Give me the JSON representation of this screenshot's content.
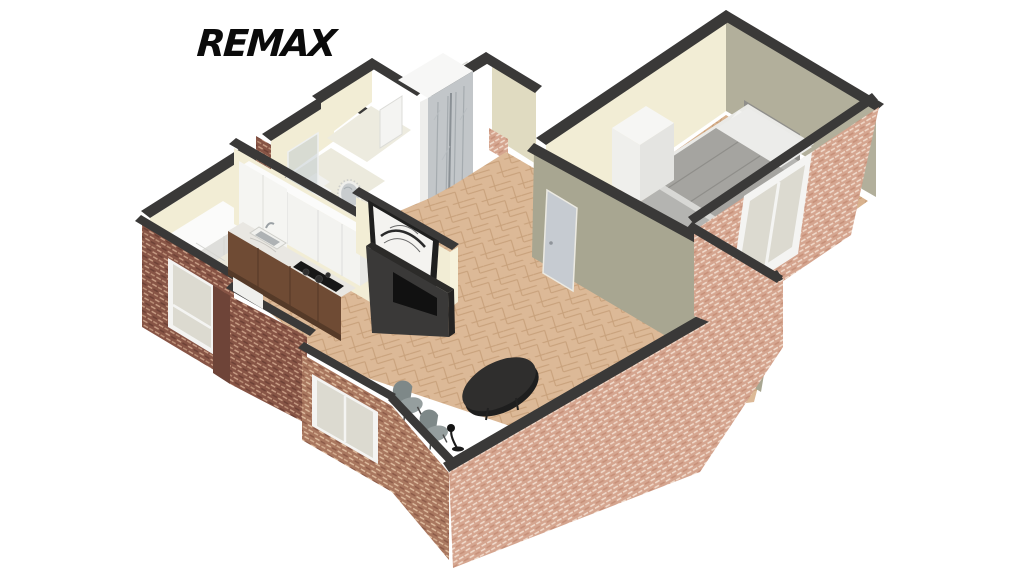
{
  "logo": {
    "text": "REMAX",
    "color": "#0b0b0b"
  },
  "scene": {
    "type": "3d-floor-plan",
    "view": "isometric cutaway dollhouse render",
    "background": "#ffffff",
    "rooms": [
      {
        "name": "bedroom",
        "position": "upper-right",
        "floor": "herringbone-wood",
        "furniture": [
          "double-bed",
          "gray-blanket",
          "white-pillows",
          "headboard",
          "area-rug",
          "white-wardrobe",
          "interior-door"
        ],
        "window": "white-frame-window-in-brick-wall"
      },
      {
        "name": "living-room",
        "position": "center",
        "floor": "herringbone-wood",
        "furniture": [
          "black-oval-coffee-table",
          "gray-chair",
          "gray-chair",
          "black-floor-lamp",
          "tv-console",
          "framed-artwork"
        ]
      },
      {
        "name": "kitchen",
        "position": "center-left",
        "floor": "herringbone-wood",
        "furniture": [
          "white-upper-cabinets",
          "tall-white-cabinet",
          "marble-countertop",
          "wood-base-cabinets",
          "black-cooktop",
          "sink-with-faucet"
        ]
      },
      {
        "name": "bathroom",
        "position": "top-left",
        "floor": "pale-tile",
        "furniture": [
          "glass-shower-panel",
          "white-fixture",
          "round-mirror"
        ]
      },
      {
        "name": "entry-hall",
        "position": "top-center",
        "floor": "wood",
        "furniture": [
          "mirrored-wardrobe",
          "front-door"
        ]
      },
      {
        "name": "storage-room",
        "position": "left",
        "floor": "pale-tile",
        "furniture": [
          "white-counter-cabinets"
        ],
        "window": "white-frame-window-in-brick-wall"
      }
    ],
    "exterior": {
      "walls": "red-brick",
      "wall_tops": "dark-gray",
      "windows": 3
    },
    "palette": {
      "capDark": "#3a3938",
      "wallCream": "#f2edd5",
      "wallCreamShade": "#e0dbc1",
      "wallOlive": "#a8a691",
      "wallOliveShade": "#b2af9b",
      "brickLight": "#d5a58f",
      "brickDark": "#875445",
      "brickMedium": "#a9775f",
      "floorWood": "#dcb997",
      "floorWoodBedroom": "#d8b28e",
      "floorPale": "#ebe8db",
      "rugGray": "#b4b4b1",
      "blanketGray": "#a5a4a0",
      "doorGray": "#c6cbd1",
      "furnitureDark": "#2b2b2b",
      "chairGray": "#8d9798",
      "marble": "#e9e7e2",
      "cabinetWood": "#6f4b34",
      "glassGray": "#dcdad0"
    }
  }
}
